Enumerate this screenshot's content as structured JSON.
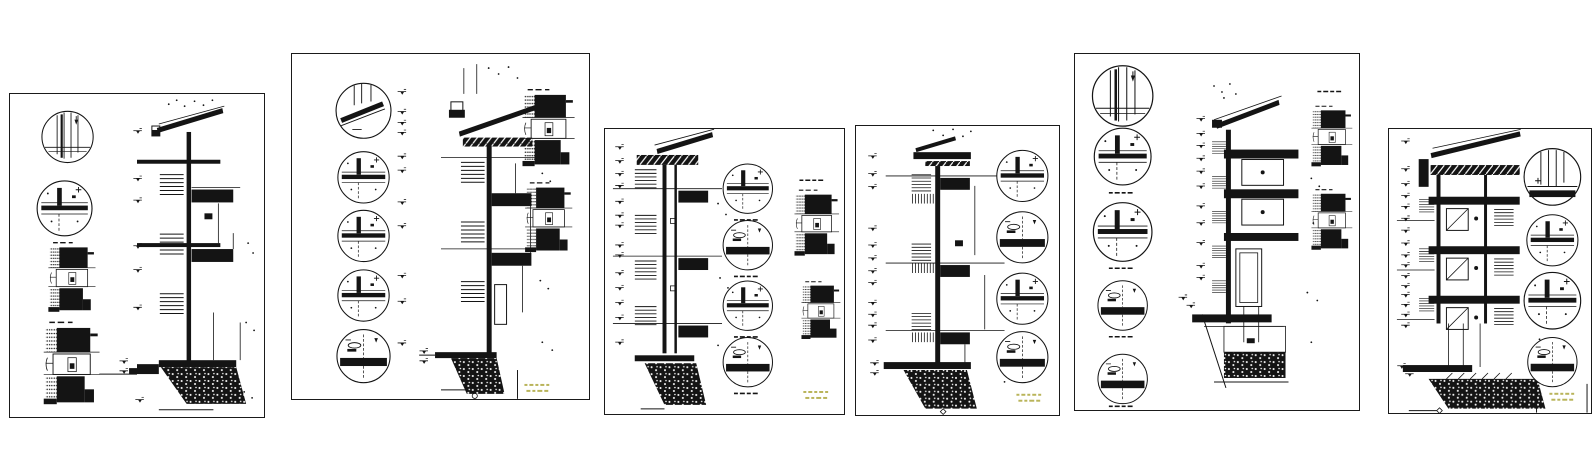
{
  "canvas": {
    "width": 1595,
    "height": 475,
    "description": "Six architectural CAD drawing sheets laid side by side, each showing a vertical wall section with floor slabs, roof eave, foundation footing, circular detail callouts and hatched plan details"
  },
  "colors": {
    "paper": "#ffffff",
    "ink": "#141414",
    "stamp": "#b9b45a",
    "sheetborder": "#1a1a1a"
  },
  "stamp": {
    "legible": false,
    "lines": 2,
    "color": "#b9b45a"
  },
  "sheets": [
    {
      "id": 1,
      "name": "wall-section-detail-sheet-1",
      "detail_circles": 2,
      "hatched_plan_details": 2,
      "level_markers": 9,
      "title_stamp": false
    },
    {
      "id": 2,
      "name": "wall-section-detail-sheet-2",
      "detail_circles": 5,
      "hatched_plan_details": 2,
      "level_markers": 15,
      "title_stamp": true
    },
    {
      "id": 3,
      "name": "wall-section-detail-sheet-3",
      "detail_circles": 4,
      "hatched_plan_details": 2,
      "level_markers": 14,
      "title_stamp": true
    },
    {
      "id": 4,
      "name": "wall-section-detail-sheet-4",
      "detail_circles": 4,
      "hatched_plan_details": 0,
      "level_markers": 14,
      "title_stamp": true
    },
    {
      "id": 5,
      "name": "wall-section-detail-sheet-5",
      "detail_circles": 5,
      "hatched_plan_details": 2,
      "level_markers": 13,
      "title_stamp": false
    },
    {
      "id": 6,
      "name": "wall-section-detail-sheet-6",
      "detail_circles": 4,
      "hatched_plan_details": 0,
      "level_markers": 18,
      "title_stamp": true
    }
  ]
}
